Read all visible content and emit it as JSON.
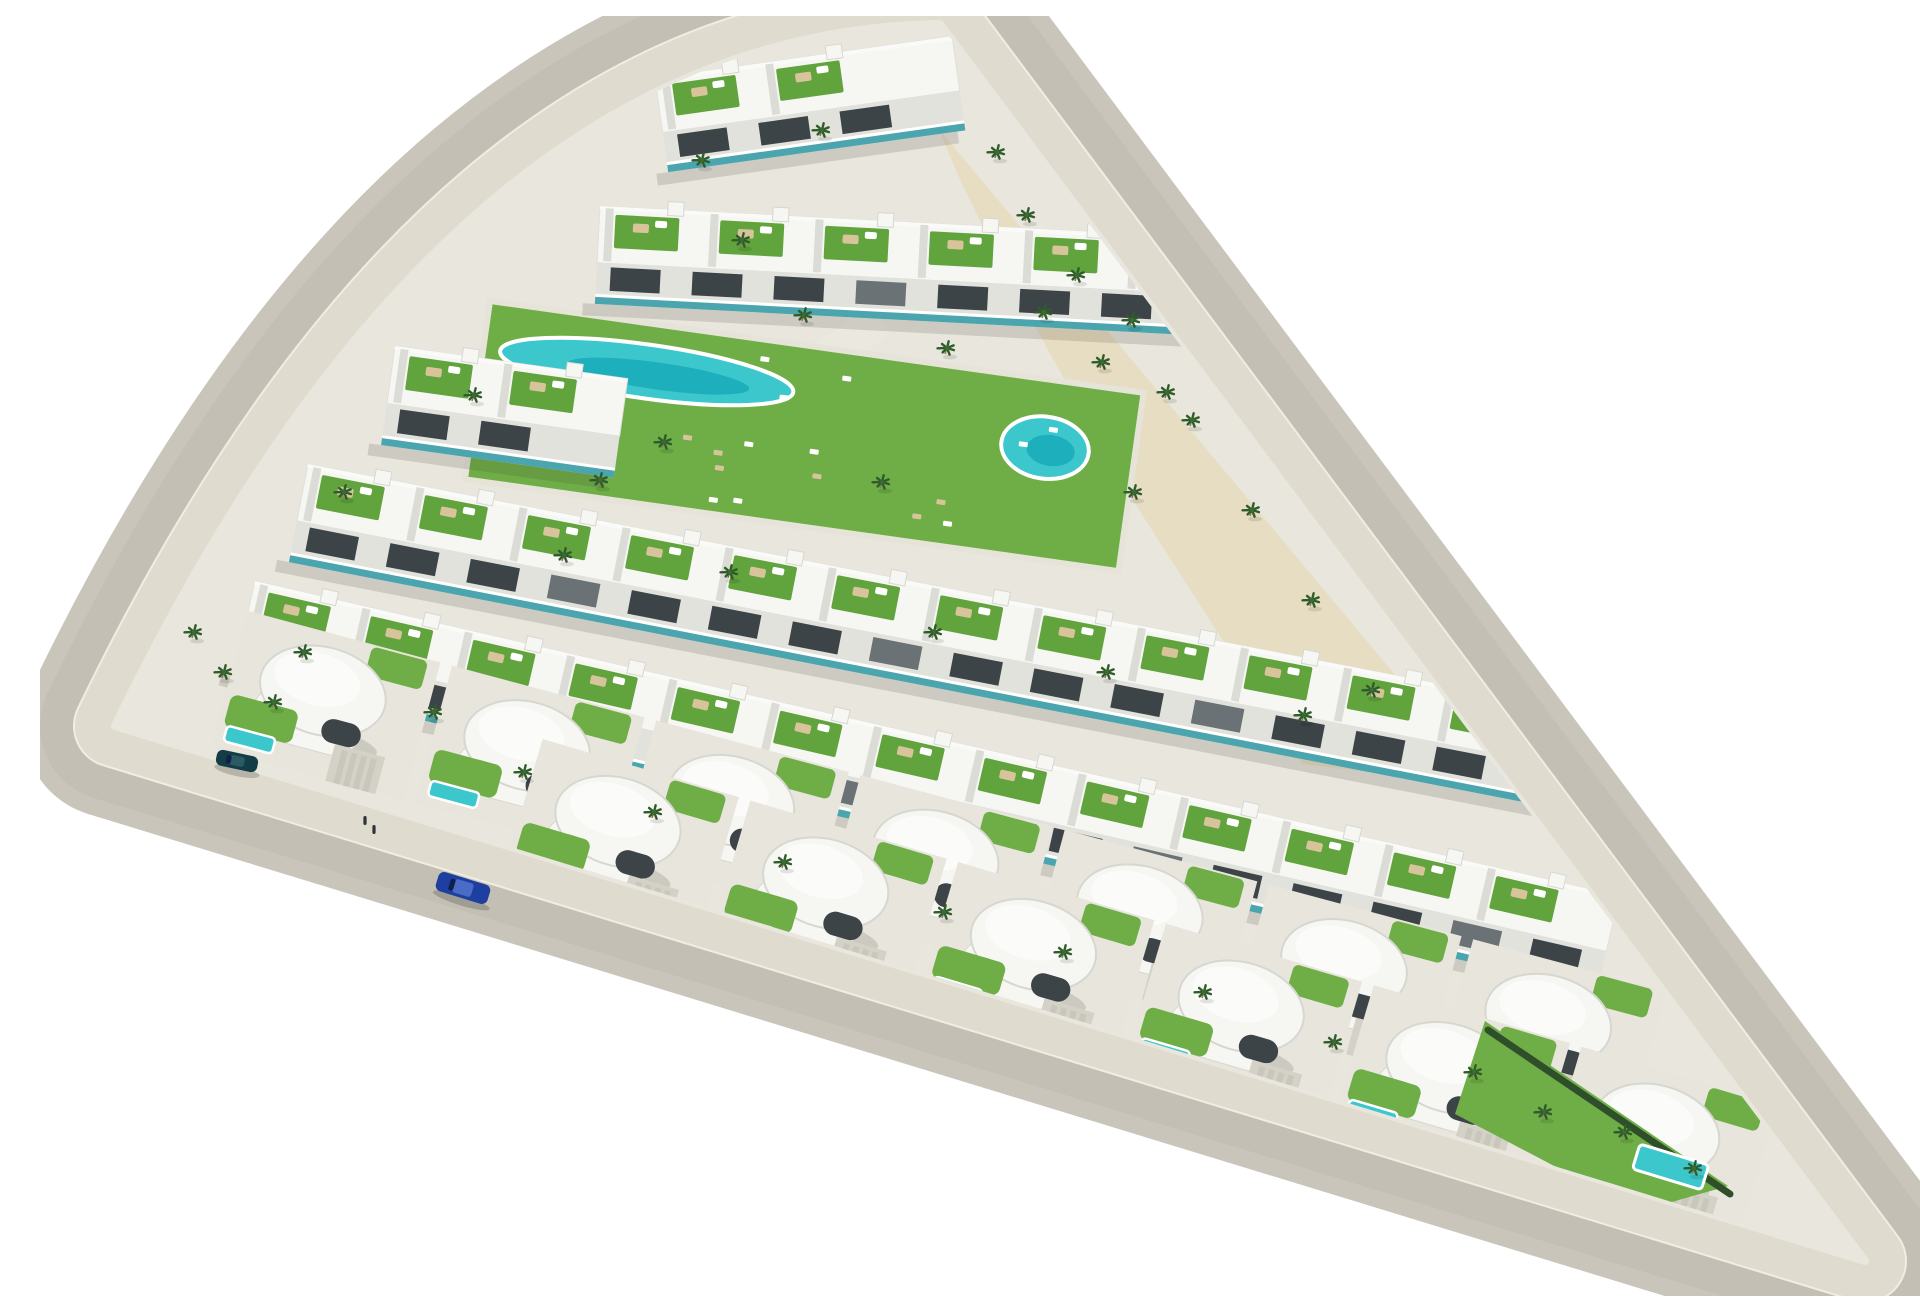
{
  "meta": {
    "title": "Aerial 3D render of a triangular residential development with white terraced apartments, green roof gardens, curved villas, turquoise pools and perimeter roads",
    "canvas": {
      "w": 1920,
      "h": 1280
    },
    "background": "#ffffff"
  },
  "palette": {
    "road": "#c9c5ba",
    "road_texture": "#b7b3a8",
    "kerb": "#f0eee3",
    "sidewalk": "#dfdbce",
    "site": "#e9e6dd",
    "plaza_sand": "#e7ddc2",
    "building": "#f6f6f3",
    "building_shade": "#d7d7d1",
    "divider": "#dcdcd6",
    "facade": "#e2e2dd",
    "window": "#3d4448",
    "window_mid": "#6b7276",
    "terrace_green": "#61a33c",
    "lawn": "#6fae47",
    "pool": "#3cc7cd",
    "pool_deep": "#17a9b8",
    "pool_rim": "#ffffff",
    "glass_teal": "#2f9aa6",
    "palm": "#2f5c2a",
    "palm_light": "#3a6b33",
    "trunk": "#8a7a5a",
    "furniture": "#d8c49a",
    "white": "#ffffff",
    "pavement": "#e8e5dc",
    "driveway_pad": "#d4d1c6",
    "driveway_stripe": "#c9c6bb",
    "shadow": "rgba(60,60,52,0.16)",
    "person": "#2e3438"
  },
  "scene": {
    "outline": {
      "a": [
        900,
        8
      ],
      "ab_ctrl": [
        410,
        15
      ],
      "b": [
        75,
        710
      ],
      "c": [
        1825,
        1245
      ]
    },
    "stroke_widths": {
      "road": 184,
      "texture": 150,
      "kerb": 84,
      "sidewalk": 80,
      "base": 8
    },
    "plaza": [
      [
        898,
        112
      ],
      [
        1448,
        770
      ],
      [
        1262,
        748
      ],
      [
        1085,
        472
      ],
      [
        968,
        262
      ],
      [
        922,
        168
      ]
    ],
    "walkway": {
      "x": 828,
      "y": 288,
      "w": 36,
      "h": 168,
      "angle": 52
    },
    "deck": {
      "x": 450,
      "y": 285,
      "angle": 8,
      "len": 660,
      "depth": 180,
      "lagoon": {
        "cx": 165,
        "cy": 48,
        "rx": 148,
        "ry": 27
      },
      "round_pool": {
        "cx": 570,
        "cy": 68,
        "rx": 44,
        "ry": 31
      },
      "lounger_area": [
        210,
        16,
        430,
        150
      ],
      "lounger_count": 16
    },
    "apartment_rows": [
      {
        "x": 615,
        "y": 62,
        "angle": -8,
        "len": 300,
        "depth": 95
      },
      {
        "x": 560,
        "y": 190,
        "angle": 3,
        "len": 640,
        "depth": 98
      },
      {
        "x": 355,
        "y": 330,
        "angle": 8,
        "len": 235,
        "depth": 100
      },
      {
        "x": 268,
        "y": 448,
        "angle": 11,
        "len": 1320,
        "depth": 100
      },
      {
        "x": 215,
        "y": 565,
        "angle": 13,
        "len": 1400,
        "depth": 98
      }
    ],
    "villa_rows": [
      {
        "x": 205,
        "y": 590,
        "angle": 15,
        "len": 1480,
        "depth": 150,
        "count": 7,
        "driveways": true
      },
      {
        "x": 500,
        "y": 718,
        "angle": 16.5,
        "len": 1300,
        "depth": 150,
        "count": 6,
        "driveways": true
      }
    ],
    "right_tip": {
      "lawn": [
        [
          1445,
          1005
        ],
        [
          1688,
          1170
        ],
        [
          1600,
          1195
        ],
        [
          1415,
          1098
        ]
      ],
      "pool": {
        "x": 1600,
        "y": 1128,
        "w": 72,
        "h": 26,
        "angle": 17
      },
      "hedge": [
        [
          1448,
          1014
        ],
        [
          1690,
          1178
        ]
      ]
    },
    "palms": [
      [
        985,
        205
      ],
      [
        1035,
        265
      ],
      [
        1080,
        235
      ],
      [
        1060,
        352
      ],
      [
        1002,
        302
      ],
      [
        1090,
        310
      ],
      [
        1125,
        382
      ],
      [
        1150,
        410
      ],
      [
        1210,
        500
      ],
      [
        1270,
        590
      ],
      [
        1330,
        680
      ],
      [
        622,
        432
      ],
      [
        762,
        305
      ],
      [
        905,
        338
      ],
      [
        1092,
        482
      ],
      [
        558,
        470
      ],
      [
        840,
        472
      ],
      [
        432,
        385
      ],
      [
        302,
        482
      ],
      [
        522,
        545
      ],
      [
        688,
        562
      ],
      [
        892,
        622
      ],
      [
        1065,
        662
      ],
      [
        1262,
        705
      ],
      [
        262,
        642
      ],
      [
        392,
        702
      ],
      [
        482,
        762
      ],
      [
        612,
        802
      ],
      [
        742,
        852
      ],
      [
        902,
        902
      ],
      [
        1022,
        942
      ],
      [
        1162,
        982
      ],
      [
        1292,
        1032
      ],
      [
        1432,
        1062
      ],
      [
        1502,
        1102
      ],
      [
        1582,
        1122
      ],
      [
        1652,
        1158
      ],
      [
        152,
        622
      ],
      [
        182,
        662
      ],
      [
        232,
        692
      ],
      [
        660,
        150
      ],
      [
        780,
        120
      ],
      [
        700,
        230
      ],
      [
        955,
        142
      ]
    ],
    "cars": [
      {
        "name": "car-blue-driving",
        "x": 423,
        "y": 872,
        "angle": 17,
        "len": 54,
        "w": 20,
        "body": "#1d3f9f",
        "roof": "#4a6cc8"
      },
      {
        "name": "car-dark-parked",
        "x": 197,
        "y": 745,
        "angle": 12,
        "len": 42,
        "w": 16,
        "body": "#123c46",
        "roof": "#2a5a64"
      }
    ],
    "pedestrians": [
      [
        325,
        808
      ],
      [
        334,
        817
      ]
    ]
  }
}
